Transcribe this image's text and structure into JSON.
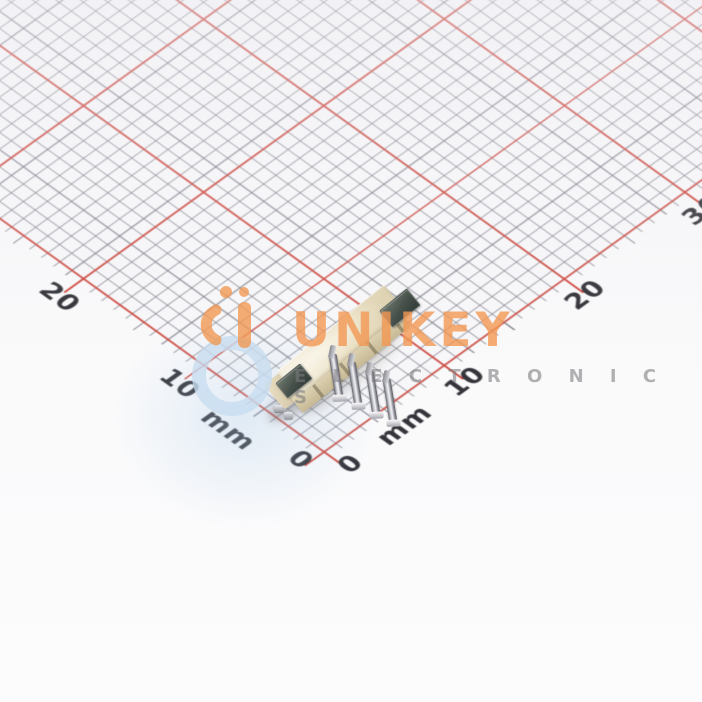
{
  "photo": {
    "description": "4-pin SMD wire-to-board connector photographed on millimeter grid paper",
    "watermark": {
      "brand": "UNIKEY",
      "subtitle": "E L E C T R O N I C S",
      "brand_color": "#f39753",
      "subtitle_color": "#7a7a7e",
      "logo_orange": "#f09a58",
      "logo_blue": "#bed7ef"
    },
    "ruler": {
      "unit_label": "mm",
      "left_axis": {
        "labels": [
          "0",
          "mm",
          "10",
          "20"
        ]
      },
      "right_axis": {
        "labels": [
          "0",
          "mm",
          "10",
          "20",
          "30"
        ]
      },
      "grid_major_color": "#d0493f",
      "grid_minor_color": "#76767e",
      "paper_color": "#f7f7f9"
    },
    "component": {
      "type": "smd-connector",
      "pin_count": "4",
      "body_color": "#eadfc3",
      "solder_pad_color": "#46504a",
      "pin_color": "#c8c8d0"
    }
  }
}
